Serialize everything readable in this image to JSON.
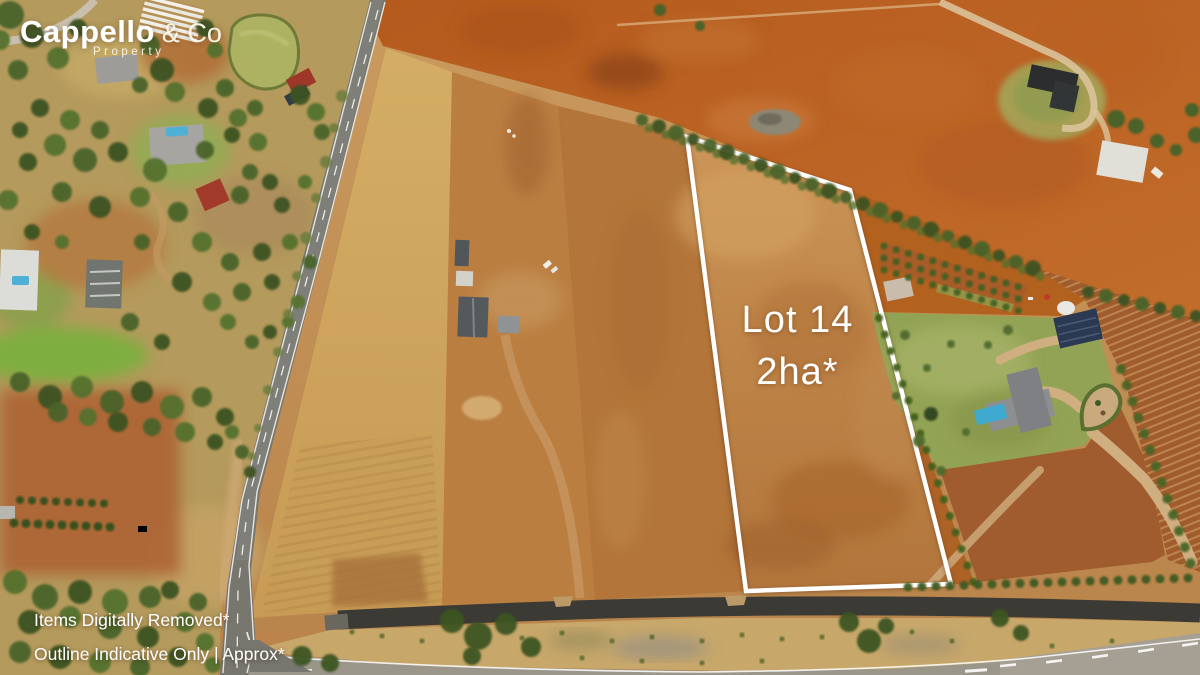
{
  "branding": {
    "name": "Cappello",
    "suffix": "& Co",
    "tagline": "Property"
  },
  "lot_overlay": {
    "title": "Lot 14",
    "area": "2ha*"
  },
  "disclaimers": {
    "line1": "Items Digitally Removed*",
    "line2": "Outline Indicative Only | Approx*"
  },
  "palette": {
    "lot_outline": "#ffffff",
    "red_soil": "#b65a22",
    "tan_paddock": "#c49257",
    "dry_grass": "#cda75f",
    "tree_green": "#3f5424",
    "lawn_green": "#8fa351",
    "road_asphalt": "#77766f",
    "dark_road": "#3b3a35",
    "pool_blue": "#45aacf"
  }
}
